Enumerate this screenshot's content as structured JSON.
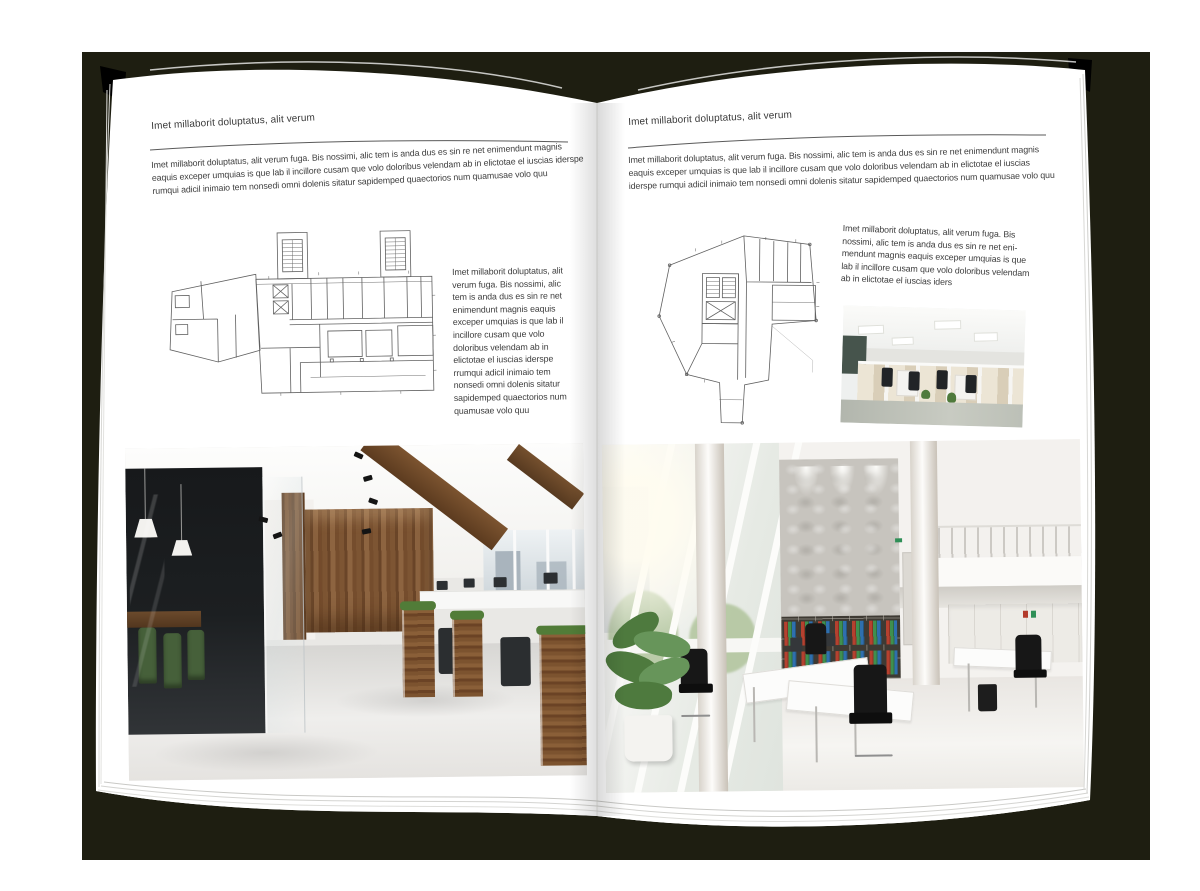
{
  "left_page": {
    "running_head": "Imet millaborit doluptatus, alit verum",
    "intro_paragraph": "Imet millaborit doluptatus, alit verum fuga. Bis nossimi, alic tem is anda dus es sin re net enimendunt magnis eaquis exceper umquias is que lab il incillore cusam que volo doloribus velendam ab in elictotae el iuscias iderspe rumqui adicil inimaio tem nonsedi omni dolenis sitatur sapidemped quaectorios num quamusae volo quu",
    "caption_column": "Imet millaborit doluptatus, alit verum fuga. Bis nossimi, alic tem is anda dus es sin re net enimendunt magnis eaquis exceper umquias is que lab il incillore cusam que volo doloribus velendam ab in elictotae el iuscias iderspe rrumqui adicil inimaio tem nonsedi omni dolenis sitatur sapidemped quaectorios num quamusae volo quu"
  },
  "right_page": {
    "running_head": "Imet millaborit doluptatus, alit verum",
    "intro_paragraph": "Imet millaborit doluptatus, alit verum fuga. Bis nossimi, alic tem is anda dus es sin re net enimendunt magnis eaquis exceper umquias is que lab il incillore cusam que volo doloribus velendam ab in elictotae el iuscias iderspe rumqui adicil inimaio tem nonsedi omni dolenis sitatur sapidemped quaectorios num quamusae volo quu",
    "caption_column": "Imet millaborit doluptatus, alit verum fuga. Bis nossimi, alic tem is anda dus es sin re net eni-mendunt magnis eaquis exceper umquias is que lab il incillore cusam que volo doloribus velendam ab in elictotae el iuscias iders"
  },
  "colors": {
    "backdrop": "#1e1e11",
    "page": "#ffffff",
    "body_text": "#3d3d3d",
    "header_rule": "#5a5a5a",
    "wood_accent": "#7a5232",
    "meeting_chair_green": "#46603a",
    "binder_red": "#b5412f",
    "binder_green": "#3f8f4f",
    "binder_blue": "#2f6fae",
    "plant_green": "#4e7a3e"
  }
}
